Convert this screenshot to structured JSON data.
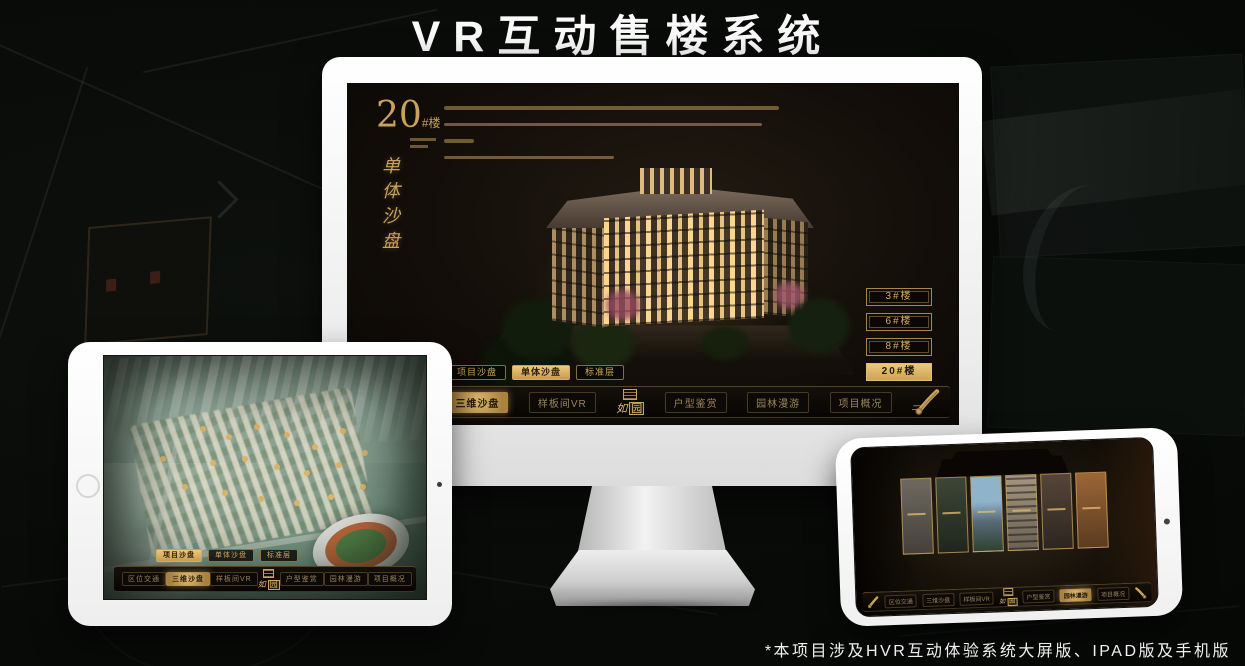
{
  "page": {
    "title": "VR互动售楼系统",
    "footnote": "*本项目涉及HVR互动体验系统大屏版、IPAD版及手机版"
  },
  "colors": {
    "gold": "#c9a25c",
    "gold_bright": "#ecc97a",
    "selected_text": "#241a0b",
    "screen_bg": "#130e09"
  },
  "logo": {
    "char_script": "如",
    "char_boxed": "园"
  },
  "nav": {
    "items": [
      {
        "label": "区位交通"
      },
      {
        "label": "三维沙盘"
      },
      {
        "label": "样板间VR"
      },
      {
        "label": "户型鉴赏"
      },
      {
        "label": "园林漫游"
      },
      {
        "label": "项目概况"
      }
    ]
  },
  "sub_tabs": {
    "items": [
      {
        "label": "项目沙盘"
      },
      {
        "label": "单体沙盘"
      },
      {
        "label": "标准层"
      }
    ]
  },
  "monitor": {
    "heading": {
      "number": "20",
      "suffix": "#楼",
      "vertical": "单体沙盘"
    },
    "building_buttons": [
      {
        "label": "3#楼"
      },
      {
        "label": "6#楼"
      },
      {
        "label": "8#楼"
      },
      {
        "label": "20#楼"
      }
    ]
  }
}
